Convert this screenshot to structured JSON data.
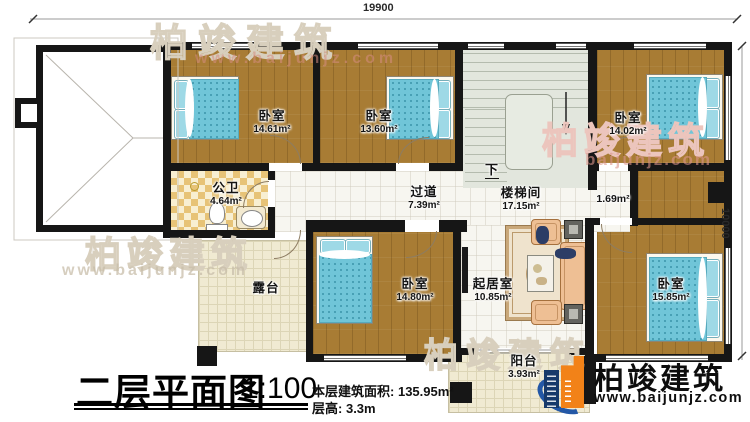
{
  "dimensions": {
    "top": "19900",
    "right": "10000"
  },
  "rooms": {
    "bedroom1": {
      "name": "卧室",
      "area": "14.61m²"
    },
    "bedroom2": {
      "name": "卧室",
      "area": "13.60m²"
    },
    "bedroom3": {
      "name": "卧室",
      "area": "14.02m²"
    },
    "bathroom": {
      "name": "公卫",
      "area": "4.64m²"
    },
    "corridor": {
      "name": "过道",
      "area": "7.39m²"
    },
    "stairwell": {
      "name": "楼梯间",
      "area": "17.15m²"
    },
    "closet": {
      "area": "1.69m²"
    },
    "bedroom4": {
      "name": "卧室",
      "area": "14.80m²"
    },
    "living": {
      "name": "起居室",
      "area": "10.85m²"
    },
    "bedroom5": {
      "name": "卧室",
      "area": "15.85m²"
    },
    "terrace": {
      "name": "露台"
    },
    "balcony": {
      "name": "阳台",
      "area": "3.93m²"
    }
  },
  "stairs": {
    "direction_label": "下"
  },
  "title_block": {
    "plan_title": "二层平面图",
    "scale": "1:100",
    "floor_area_label": "本层建筑面积:",
    "floor_area_value": "135.95m²",
    "floor_height_label": "层高:",
    "floor_height_value": "3.3m"
  },
  "logo": {
    "company": "柏竣建筑",
    "website": "www.baijunjz.com"
  },
  "watermarks": {
    "top": {
      "company": "柏竣建筑",
      "website": "www.baijunjz.com"
    },
    "left": {
      "company": "柏竣建筑",
      "website": "www.baijunjz.com"
    },
    "right": {
      "company": "柏竣建筑",
      "website": "baijunjz.com"
    },
    "bottom": {
      "company": "柏竣建筑"
    }
  },
  "colors": {
    "wall": "#161616",
    "wood_floor": "#a87c34",
    "bed_teal": "#70c5d8",
    "cream_tile": "#f0ead2",
    "bath_tile": "#e7c377",
    "stair_floor": "#e2e6dd",
    "logo_orange": "#f28218",
    "logo_blue": "#1f4f9c"
  }
}
